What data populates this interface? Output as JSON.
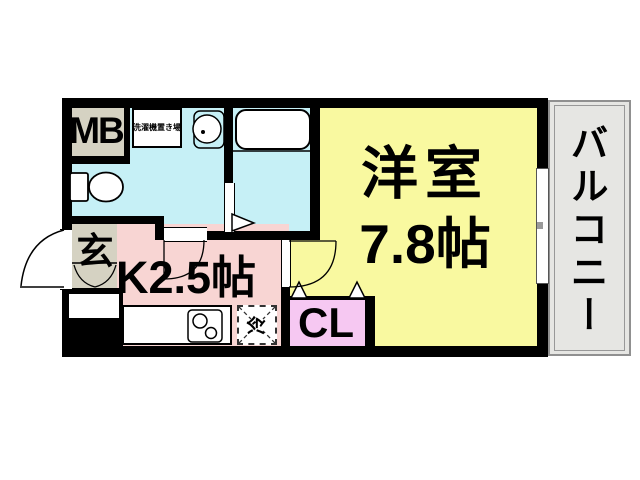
{
  "floorplan": {
    "meter_box": {
      "label": "MB"
    },
    "laundry": {
      "label": "洗濯機置き場"
    },
    "entrance": {
      "label": "玄"
    },
    "kitchen": {
      "label": "K2.5帖"
    },
    "closet": {
      "label": "CL"
    },
    "western_room": {
      "name": "洋室",
      "size": "7.8帖"
    },
    "balcony": {
      "label": "バルコニー"
    },
    "refrigerator": {
      "label": "冷"
    }
  },
  "colors": {
    "washroom_cyan": "#c6f0f6",
    "room_yellow": "#f9f9a0",
    "kitchen_pink": "#f8d5d3",
    "closet_pink": "#f6c8f2",
    "utility_beige": "#d5d2c2",
    "balcony_gray": "#e6e6e3",
    "wall_black": "#000000"
  }
}
